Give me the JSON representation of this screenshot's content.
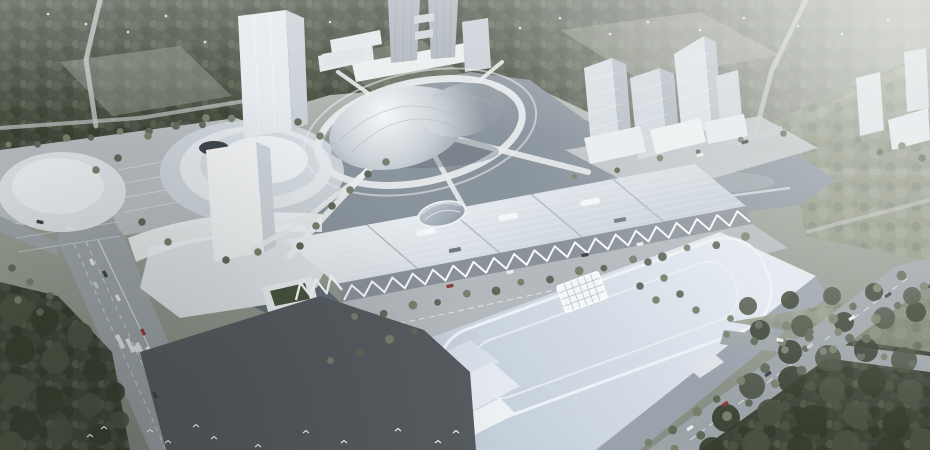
{
  "scene": {
    "type": "architectural-aerial-rendering",
    "subject": "Aerial rendering of a civic cultural complex: metallic domed theater on a ring road island, long ribbed exhibition hall with white truss facade, flat blue-roofed convention hall with racetrack roof pattern and grid skylight, twin supertall towers, angular office tower cluster, terraced cultural center, lake, tree-lined boulevards and surrounding forest",
    "visible_text": "none"
  },
  "colors": {
    "sky_top": "#c3c8c6",
    "ground": "#848b80",
    "forest_dark_base": "#3f4538",
    "forest_blob_a": "#4a5243",
    "forest_blob_b": "#353d2e",
    "forest_light_base": "#8d937f",
    "field": "#9aa08f",
    "water": "#8a949d",
    "water_dark": "#636d77",
    "road_light": "#c7cbce",
    "road_mid": "#9da4a9",
    "plaza_light": "#b7bcc0",
    "plaza_dark": "#565b60",
    "white_bld": "#eef1f3",
    "face_light": "#dde2e7",
    "face_mid": "#c6cdd4",
    "face_dark": "#a5aeb6",
    "tower_glass": "#a9b1b9",
    "dome_hi": "#f5f7f8",
    "dome_lo": "#8e97a0",
    "roof_hall_hi": "#e9eef2",
    "roof_hall_lo": "#c9d1d8",
    "roof_arena_hi": "#e3e9f1",
    "roof_arena_lo": "#c3ceda",
    "truss": "#f7f9fa",
    "tree_row": "#5f695a",
    "tree_row2": "#77806c",
    "green_roof": "#47523f",
    "courtyard": "#3e454c"
  },
  "decorations": {
    "car_palette": [
      "#e9ebec",
      "#3c4146",
      "#8d3a35",
      "#c9cccf"
    ],
    "tree_rows": [
      {
        "from": [
          356,
          318
        ],
        "to": [
          744,
          238
        ],
        "count": 15,
        "r": 4
      },
      {
        "from": [
          650,
          444
        ],
        "to": [
          900,
          274
        ],
        "count": 12,
        "r": 4.5
      },
      {
        "from": [
          676,
          450
        ],
        "to": [
          924,
          288
        ],
        "count": 11,
        "r": 4.5
      },
      {
        "from": [
          732,
          320
        ],
        "to": [
          918,
          344
        ],
        "count": 8,
        "r": 4
      },
      {
        "from": [
          728,
          336
        ],
        "to": [
          912,
          362
        ],
        "count": 8,
        "r": 4
      },
      {
        "from": [
          10,
          146
        ],
        "to": [
          230,
          120
        ],
        "count": 9,
        "r": 3.5
      },
      {
        "from": [
          332,
          362
        ],
        "to": [
          416,
          330
        ],
        "count": 4,
        "r": 4
      },
      {
        "from": [
          576,
          178
        ],
        "to": [
          782,
          132
        ],
        "count": 6,
        "r": 3
      }
    ],
    "tree_spots": [
      [
        148,
        136
      ],
      [
        176,
        126
      ],
      [
        206,
        118
      ],
      [
        298,
        122
      ],
      [
        320,
        136
      ],
      [
        142,
        222
      ],
      [
        168,
        242
      ],
      [
        226,
        260
      ],
      [
        258,
        252
      ],
      [
        118,
        158
      ],
      [
        96,
        170
      ],
      [
        300,
        246
      ],
      [
        316,
        226
      ],
      [
        332,
        206
      ],
      [
        350,
        190
      ],
      [
        368,
        174
      ],
      [
        386,
        162
      ],
      [
        648,
        262
      ],
      [
        664,
        278
      ],
      [
        680,
        294
      ],
      [
        696,
        310
      ],
      [
        640,
        286
      ],
      [
        656,
        300
      ],
      [
        12,
        268
      ],
      [
        30,
        282
      ],
      [
        50,
        296
      ],
      [
        18,
        300
      ],
      [
        40,
        312
      ],
      [
        858,
        140
      ],
      [
        880,
        152
      ],
      [
        902,
        146
      ],
      [
        922,
        158
      ]
    ],
    "forest_br": [
      [
        712,
        450,
        13
      ],
      [
        756,
        444,
        14
      ],
      [
        800,
        448,
        13
      ],
      [
        846,
        444,
        14
      ],
      [
        890,
        448,
        13
      ],
      [
        922,
        440,
        12
      ],
      [
        726,
        418,
        14
      ],
      [
        770,
        412,
        13
      ],
      [
        812,
        420,
        15
      ],
      [
        856,
        414,
        13
      ],
      [
        896,
        424,
        14
      ],
      [
        752,
        386,
        13
      ],
      [
        792,
        380,
        14
      ],
      [
        832,
        390,
        13
      ],
      [
        872,
        382,
        14
      ],
      [
        910,
        392,
        13
      ],
      [
        790,
        352,
        12
      ],
      [
        828,
        358,
        13
      ],
      [
        866,
        350,
        12
      ],
      [
        904,
        360,
        13
      ],
      [
        760,
        330,
        10
      ],
      [
        802,
        326,
        11
      ],
      [
        844,
        322,
        10
      ],
      [
        884,
        318,
        11
      ],
      [
        916,
        312,
        10
      ],
      [
        748,
        306,
        9
      ],
      [
        790,
        300,
        9
      ],
      [
        832,
        296,
        9
      ],
      [
        874,
        292,
        9
      ],
      [
        912,
        296,
        9
      ]
    ],
    "forest_bl": [
      [
        15,
        310,
        16
      ],
      [
        45,
        320,
        14
      ],
      [
        80,
        335,
        13
      ],
      [
        20,
        350,
        15
      ],
      [
        55,
        360,
        14
      ],
      [
        95,
        370,
        12
      ],
      [
        15,
        390,
        16
      ],
      [
        50,
        400,
        14
      ],
      [
        90,
        405,
        12
      ],
      [
        25,
        425,
        15
      ],
      [
        60,
        432,
        13
      ],
      [
        100,
        435,
        11
      ],
      [
        10,
        445,
        14
      ],
      [
        115,
        392,
        10
      ],
      [
        120,
        420,
        9
      ]
    ],
    "cars": [
      [
        92,
        262,
        62,
        0
      ],
      [
        105,
        274,
        62,
        1
      ],
      [
        118,
        298,
        62,
        0
      ],
      [
        143,
        332,
        62,
        2
      ],
      [
        136,
        349,
        62,
        0
      ],
      [
        155,
        395,
        63,
        1
      ],
      [
        96,
        285,
        62,
        3
      ],
      [
        450,
        286,
        -11,
        2
      ],
      [
        510,
        272,
        -11,
        0
      ],
      [
        585,
        255,
        -11,
        1
      ],
      [
        640,
        244,
        -11,
        0
      ],
      [
        690,
        428,
        -34,
        0
      ],
      [
        725,
        404,
        -34,
        2
      ],
      [
        768,
        374,
        -34,
        1
      ],
      [
        810,
        346,
        -34,
        3
      ],
      [
        852,
        318,
        -34,
        0
      ],
      [
        888,
        295,
        -34,
        1
      ],
      [
        780,
        340,
        8,
        0
      ],
      [
        860,
        352,
        8,
        1
      ],
      [
        700,
        155,
        -12,
        0
      ],
      [
        745,
        142,
        -16,
        1
      ],
      [
        70,
        228,
        12,
        0
      ],
      [
        40,
        222,
        12,
        1
      ]
    ],
    "birds": [
      [
        90,
        436
      ],
      [
        104,
        428
      ],
      [
        150,
        431
      ],
      [
        168,
        442
      ],
      [
        196,
        426
      ],
      [
        214,
        438
      ],
      [
        258,
        446
      ],
      [
        306,
        432
      ],
      [
        344,
        442
      ],
      [
        398,
        430
      ],
      [
        438,
        442
      ],
      [
        456,
        432
      ]
    ],
    "piers": [
      [
        628,
        208
      ],
      [
        642,
        206
      ],
      [
        656,
        204
      ],
      [
        670,
        202
      ],
      [
        684,
        200
      ],
      [
        698,
        198
      ],
      [
        712,
        196
      ],
      [
        726,
        194
      ]
    ],
    "parking_lines": [
      [
        8,
        182,
        104,
        166
      ],
      [
        10,
        196,
        108,
        180
      ],
      [
        12,
        210,
        112,
        194
      ],
      [
        14,
        224,
        116,
        208
      ],
      [
        16,
        238,
        118,
        222
      ],
      [
        18,
        252,
        120,
        236
      ],
      [
        118,
        170,
        215,
        152
      ],
      [
        120,
        184,
        218,
        166
      ],
      [
        122,
        198,
        220,
        180
      ],
      [
        124,
        212,
        222,
        194
      ]
    ],
    "specks": [
      [
        48,
        14
      ],
      [
        86,
        24
      ],
      [
        128,
        32
      ],
      [
        166,
        16
      ],
      [
        205,
        42
      ],
      [
        248,
        30
      ],
      [
        298,
        46
      ],
      [
        330,
        22
      ],
      [
        362,
        38
      ],
      [
        520,
        28
      ],
      [
        560,
        18
      ],
      [
        610,
        34
      ],
      [
        648,
        22
      ],
      [
        700,
        30
      ],
      [
        744,
        18
      ],
      [
        798,
        26
      ],
      [
        842,
        34
      ],
      [
        888,
        20
      ]
    ],
    "trusses": [
      {
        "from": [
          344,
          300
        ],
        "to": [
          750,
          222
        ],
        "peaks": 20,
        "h": 13,
        "w": 2
      },
      {
        "from": [
          296,
          300
        ],
        "to": [
          342,
          290
        ],
        "peaks": 3,
        "h": 16,
        "w": 2.4
      }
    ]
  }
}
